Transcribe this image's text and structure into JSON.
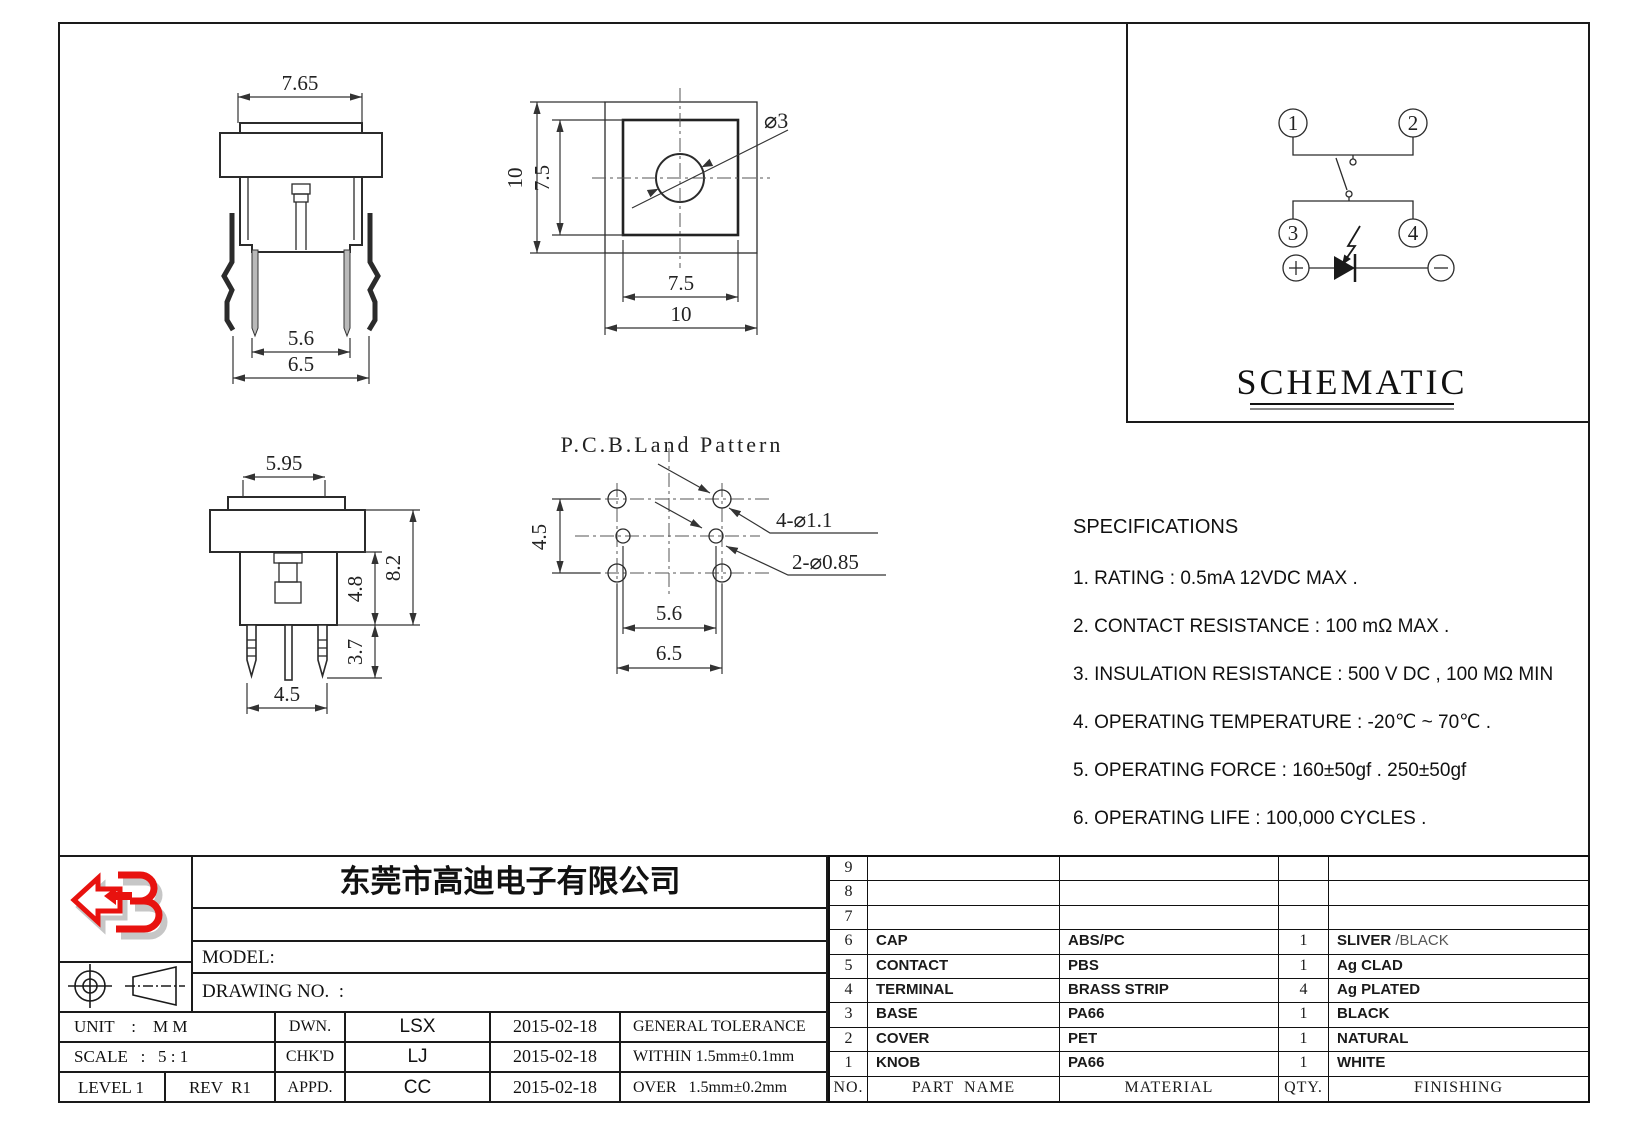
{
  "front_view": {
    "dim_top": "7.65",
    "dim_inner": "5.6",
    "dim_outer": "6.5"
  },
  "top_view": {
    "dim_left": "10",
    "dim_left_inner": "7.5",
    "dim_bottom_inner": "7.5",
    "dim_bottom": "10",
    "hole_label": "⌀3"
  },
  "side_view": {
    "dim_top": "5.95",
    "dim_body": "4.8",
    "dim_total": "8.2",
    "dim_lead": "3.7",
    "dim_span": "4.5"
  },
  "pcb_view": {
    "title": "P.C.B.Land Pattern",
    "dim_vertical": "4.5",
    "dim_inner": "5.6",
    "dim_outer": "6.5",
    "label_corner_holes": "4-⌀1.1",
    "label_center_holes": "2-⌀0.85"
  },
  "schematic": {
    "title": "SCHEMATIC",
    "pin1": "1",
    "pin2": "2",
    "pin3": "3",
    "pin4": "4",
    "plus": "+",
    "minus": "−"
  },
  "specs": {
    "title": "SPECIFICATIONS",
    "items": [
      "1. RATING : 0.5mA 12VDC MAX .",
      "2. CONTACT RESISTANCE : 100 mΩ MAX .",
      "3. INSULATION RESISTANCE : 500 V DC , 100 MΩ MIN",
      "4. OPERATING TEMPERATURE : -20℃ ~ 70℃ .",
      "5. OPERATING FORCE : 160±50gf . 250±50gf",
      "6. OPERATING LIFE : 100,000 CYCLES ."
    ]
  },
  "title_block": {
    "company": "东莞市高迪电子有限公司",
    "title_label": "TITLE :",
    "title_value": "LLLUMINATED TACTILE SWITCH",
    "model_label": "MODEL:",
    "drawing_label": "DRAWING NO.  :",
    "unit": "UNIT    :    M M",
    "dwn_label": "DWN.",
    "dwn": "LSX",
    "dwn_date": "2015-02-18",
    "tolerance_title": "GENERAL TOLERANCE",
    "scale": "SCALE   :   5 : 1",
    "chk_label": "CHK'D",
    "chk": "LJ",
    "chk_date": "2015-02-18",
    "tolerance_within": "WITHIN 1.5mm±0.1mm",
    "level": "LEVEL 1",
    "rev": "REV  R1",
    "appd_label": "APPD.",
    "appd": "CC",
    "appd_date": "2015-02-18",
    "tolerance_over": "OVER   1.5mm±0.2mm"
  },
  "parts_table": {
    "cap_finishing_alt": " /BLACK",
    "rows": [
      {
        "no": "9",
        "name": "",
        "material": "",
        "qty": "",
        "finishing": ""
      },
      {
        "no": "8",
        "name": "",
        "material": "",
        "qty": "",
        "finishing": ""
      },
      {
        "no": "7",
        "name": "",
        "material": "",
        "qty": "",
        "finishing": ""
      },
      {
        "no": "6",
        "name": "CAP",
        "material": "ABS/PC",
        "qty": "1",
        "finishing": "SLIVER"
      },
      {
        "no": "5",
        "name": "CONTACT",
        "material": "PBS",
        "qty": "1",
        "finishing": "Ag CLAD"
      },
      {
        "no": "4",
        "name": "TERMINAL",
        "material": "BRASS STRIP",
        "qty": "4",
        "finishing": "Ag PLATED"
      },
      {
        "no": "3",
        "name": "BASE",
        "material": "PA66",
        "qty": "1",
        "finishing": "BLACK"
      },
      {
        "no": "2",
        "name": "COVER",
        "material": "PET",
        "qty": "1",
        "finishing": "NATURAL"
      },
      {
        "no": "1",
        "name": "KNOB",
        "material": "PA66",
        "qty": "1",
        "finishing": "WHITE"
      },
      {
        "no": "NO.",
        "name": "PART  NAME",
        "material": "MATERIAL",
        "qty": "QTY.",
        "finishing": "FINISHING"
      }
    ]
  }
}
